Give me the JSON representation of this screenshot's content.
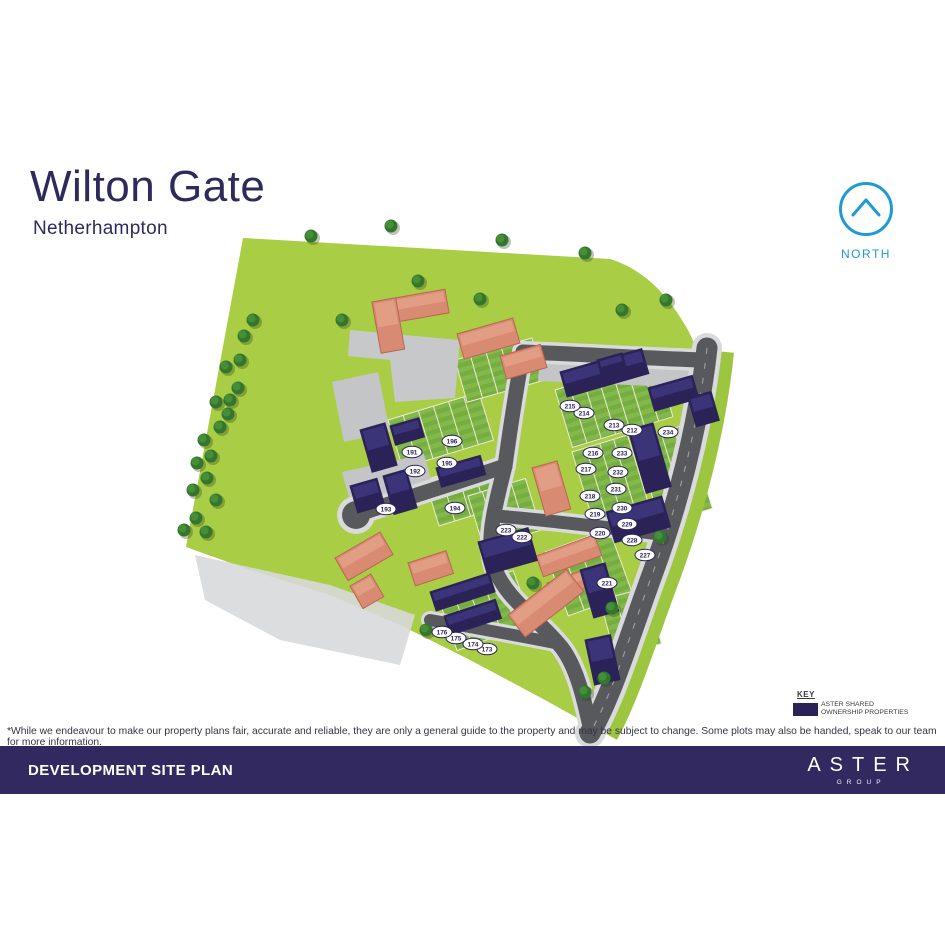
{
  "header": {
    "title": "Wilton Gate",
    "subtitle": "Netherhampton"
  },
  "north": {
    "label": "NORTH",
    "color": "#1e9ad6"
  },
  "key": {
    "heading": "KEY",
    "swatch_color": "#2b2358",
    "label_line1": "ASTER SHARED",
    "label_line2": "OWNERSHIP PROPERTIES"
  },
  "disclaimer": "*While we endeavour to make our property plans fair, accurate and reliable, they are only a general guide to the property and may be subject to change. Some plots may also be handed, speak to our team for more information.",
  "footer": {
    "title": "DEVELOPMENT SITE PLAN",
    "brand_name": "ASTER",
    "brand_sub": "GROUP",
    "bar_color": "#322960"
  },
  "map": {
    "colors": {
      "field": "#a9cd44",
      "verge": "#9cc63f",
      "road": "#58595c",
      "pavement": "#d9dadb",
      "court": "#c3c5c7",
      "garden": "#76ad40",
      "garden_stripe": "#83b94b",
      "fence": "#efe9d6",
      "aster": "#2b2358",
      "aster_roof": "#3b3478",
      "market": "#d98a72",
      "market_roof": "#e29d85",
      "market_edge": "#b96752",
      "tree": "#35762f",
      "tree_light": "#478e39",
      "plot_stroke": "#2b2358"
    },
    "plots": [
      {
        "n": "173",
        "x": 487,
        "y": 649
      },
      {
        "n": "174",
        "x": 473,
        "y": 644
      },
      {
        "n": "175",
        "x": 456,
        "y": 638
      },
      {
        "n": "176",
        "x": 442,
        "y": 632
      },
      {
        "n": "191",
        "x": 412,
        "y": 452
      },
      {
        "n": "192",
        "x": 415,
        "y": 471
      },
      {
        "n": "193",
        "x": 386,
        "y": 509
      },
      {
        "n": "194",
        "x": 455,
        "y": 508
      },
      {
        "n": "195",
        "x": 447,
        "y": 463
      },
      {
        "n": "196",
        "x": 452,
        "y": 441
      },
      {
        "n": "212",
        "x": 632,
        "y": 430
      },
      {
        "n": "213",
        "x": 614,
        "y": 425
      },
      {
        "n": "214",
        "x": 584,
        "y": 413
      },
      {
        "n": "215",
        "x": 570,
        "y": 406
      },
      {
        "n": "216",
        "x": 593,
        "y": 453
      },
      {
        "n": "217",
        "x": 586,
        "y": 469
      },
      {
        "n": "218",
        "x": 590,
        "y": 496
      },
      {
        "n": "219",
        "x": 595,
        "y": 514
      },
      {
        "n": "220",
        "x": 600,
        "y": 533
      },
      {
        "n": "221",
        "x": 607,
        "y": 583
      },
      {
        "n": "222",
        "x": 522,
        "y": 537
      },
      {
        "n": "223",
        "x": 506,
        "y": 530
      },
      {
        "n": "227",
        "x": 645,
        "y": 555
      },
      {
        "n": "228",
        "x": 632,
        "y": 540
      },
      {
        "n": "229",
        "x": 627,
        "y": 524
      },
      {
        "n": "230",
        "x": 622,
        "y": 508
      },
      {
        "n": "231",
        "x": 616,
        "y": 489
      },
      {
        "n": "232",
        "x": 618,
        "y": 472
      },
      {
        "n": "233",
        "x": 622,
        "y": 453
      },
      {
        "n": "234",
        "x": 668,
        "y": 432
      }
    ],
    "buildings": {
      "aster": [
        [
          560,
          372,
          85,
          26,
          -16
        ],
        [
          648,
          388,
          46,
          24,
          -16
        ],
        [
          688,
          398,
          24,
          30,
          -16
        ],
        [
          628,
          430,
          26,
          66,
          -16
        ],
        [
          606,
          512,
          58,
          32,
          -16
        ],
        [
          580,
          570,
          26,
          50,
          -16
        ],
        [
          478,
          542,
          52,
          34,
          -16
        ],
        [
          436,
          468,
          46,
          20,
          -16
        ],
        [
          360,
          430,
          26,
          44,
          -16
        ],
        [
          390,
          426,
          30,
          20,
          -16
        ],
        [
          350,
          486,
          28,
          28,
          -16
        ],
        [
          383,
          476,
          24,
          40,
          -16
        ],
        [
          430,
          592,
          62,
          20,
          -18
        ],
        [
          444,
          616,
          54,
          20,
          -18
        ],
        [
          585,
          640,
          26,
          46,
          -12
        ],
        [
          597,
          360,
          26,
          16,
          -16
        ]
      ],
      "market": [
        [
          372,
          302,
          74,
          24,
          -10
        ],
        [
          372,
          302,
          24,
          52,
          -10
        ],
        [
          457,
          334,
          58,
          26,
          -16
        ],
        [
          500,
          356,
          42,
          24,
          -16
        ],
        [
          532,
          468,
          26,
          50,
          -16
        ],
        [
          536,
          556,
          62,
          22,
          -20
        ],
        [
          547,
          583,
          56,
          18,
          -20
        ],
        [
          408,
          563,
          40,
          24,
          -18
        ],
        [
          335,
          558,
          52,
          26,
          -30
        ],
        [
          350,
          586,
          24,
          26,
          -30
        ],
        [
          508,
          615,
          74,
          28,
          -38
        ]
      ]
    },
    "gardens": [
      [
        388,
        420,
        95,
        50,
        -17,
        6
      ],
      [
        425,
        480,
        66,
        48,
        -17,
        4
      ],
      [
        455,
        360,
        80,
        44,
        -16,
        5
      ],
      [
        555,
        390,
        105,
        60,
        -17,
        7
      ],
      [
        572,
        452,
        58,
        76,
        -17,
        4
      ],
      [
        635,
        440,
        54,
        88,
        -17,
        4
      ],
      [
        468,
        496,
        60,
        54,
        -17,
        4
      ],
      [
        438,
        598,
        80,
        56,
        -20,
        5
      ],
      [
        545,
        552,
        68,
        68,
        -20,
        4
      ],
      [
        600,
        600,
        48,
        58,
        -15,
        3
      ]
    ],
    "trees": [
      [
        311,
        236
      ],
      [
        391,
        226
      ],
      [
        502,
        240
      ],
      [
        585,
        253
      ],
      [
        480,
        299
      ],
      [
        666,
        300
      ],
      [
        622,
        310
      ],
      [
        342,
        320
      ],
      [
        418,
        281
      ],
      [
        253,
        320
      ],
      [
        244,
        336
      ],
      [
        240,
        360
      ],
      [
        226,
        367
      ],
      [
        238,
        388
      ],
      [
        230,
        400
      ],
      [
        216,
        402
      ],
      [
        228,
        414
      ],
      [
        220,
        427
      ],
      [
        204,
        440
      ],
      [
        211,
        456
      ],
      [
        197,
        463
      ],
      [
        207,
        478
      ],
      [
        193,
        490
      ],
      [
        216,
        500
      ],
      [
        196,
        518
      ],
      [
        184,
        530
      ],
      [
        206,
        532
      ],
      [
        533,
        583
      ],
      [
        612,
        608
      ],
      [
        660,
        537
      ],
      [
        426,
        630
      ],
      [
        585,
        692
      ],
      [
        604,
        678
      ]
    ]
  }
}
